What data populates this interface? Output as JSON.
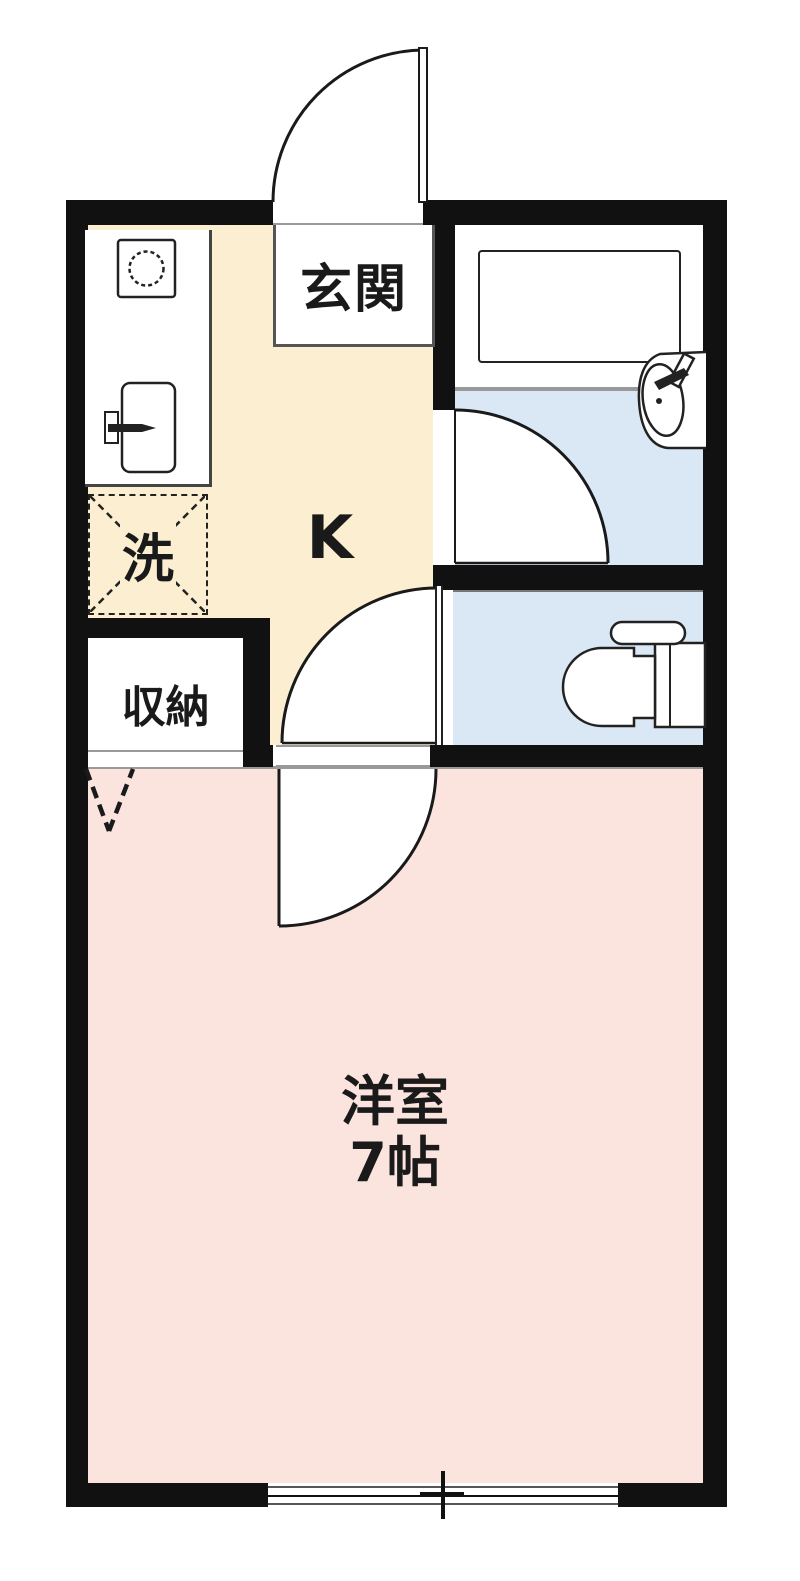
{
  "floorplan": {
    "type": "1K apartment floor plan",
    "rooms": {
      "entrance": {
        "label": "玄関"
      },
      "kitchen": {
        "label": "K"
      },
      "laundry": {
        "label": "洗"
      },
      "storage": {
        "label": "収納"
      },
      "western_room": {
        "label": "洋室",
        "size": "7帖"
      }
    },
    "colors": {
      "kitchen_floor": "#FCEED1",
      "wet_area_floor": "#D9E8F4",
      "western_room_floor": "#FBE3DE",
      "wall": "#111111",
      "line_gray": "#999999",
      "background": "#FFFFFF"
    },
    "icons": [
      "entrance-door-swing",
      "stove-icon",
      "kitchen-sink-icon",
      "bathtub-icon",
      "washbasin-icon",
      "toilet-icon",
      "bath-door-swing",
      "toilet-door-swing",
      "room-door-swing",
      "folding-door-mark",
      "sliding-window"
    ]
  }
}
